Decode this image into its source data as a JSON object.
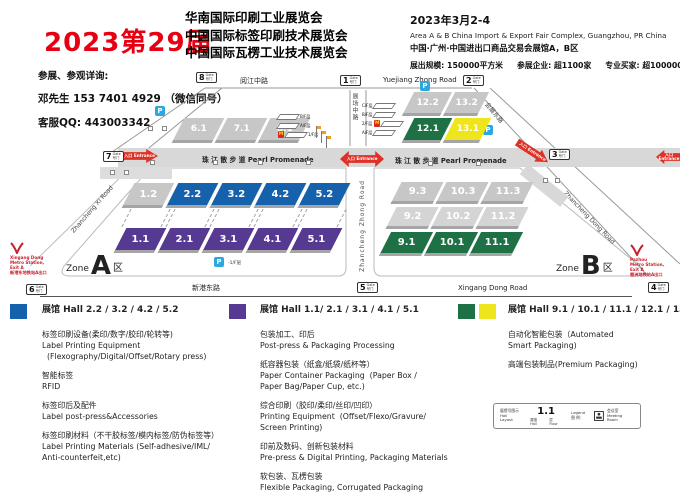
{
  "colors": {
    "red": "#e60012",
    "hall_blue": "#1661ab",
    "hall_purple": "#563a92",
    "hall_green": "#1e7145",
    "hall_yellow": "#efe51d",
    "hall_gray": "#c7c7c7",
    "arrow_red": "#df3126",
    "parking_blue": "#2aa8df",
    "metro_red": "#c8202f"
  },
  "header": {
    "edition": "2023第29届",
    "title1": "华南国际印刷工业展览会",
    "title2": "中国国际标签印刷技术展览会",
    "title3": "中国国际瓦楞工业技术展览会",
    "date": "2023年3月2-4",
    "venue_en": "Area A & B China Import & Export Fair Complex, Guangzhou, PR China",
    "venue_cn": "中国·广州·中国进出口商品交易会展馆A，B区",
    "stat_scale": "展出规模: 150000平方米",
    "stat_exhibitors": "参展企业: 超1100家",
    "stat_buyers": "专业买家: 超100000人"
  },
  "contact": {
    "line1": "参展、参观详询:",
    "line2": "邓先生 153 7401 4929 （微信同号）",
    "line3": "客服QQ: 443003342"
  },
  "map": {
    "roads": {
      "top_cn": "阅江中路",
      "top_en": "Yuejiang Zhong Road",
      "bottom_cn": "新港东路",
      "bottom_en": "Xingang Dong Road",
      "mid_cn": "展场中路",
      "upper_right_cn": "会展东路",
      "zone_a_diag": "Zhancheng Xi Road",
      "zone_b_left": "Zhancheng Zhong Road",
      "zone_b_diag": "Zhancheng Dong Road"
    },
    "promenade": "珠 江 散 步 道 Pearl Promenade",
    "entrance": "入口 Entrance",
    "gate_en": "Gate",
    "gate_cn": "号门",
    "gates": {
      "g1": "1",
      "g2": "2",
      "g3": "3",
      "g4": "4",
      "g5": "5",
      "g6": "6",
      "g7": "7",
      "g8": "8"
    },
    "parking": "P",
    "parking_note": "-1/F层",
    "zone_a": {
      "word": "Zone",
      "letter": "A",
      "cn": "区"
    },
    "zone_b": {
      "word": "Zone",
      "letter": "B",
      "cn": "区"
    },
    "metro_left": {
      "l1": "Xingang Dong",
      "l2": "Metro Station,",
      "l3": "Exit A",
      "l4": "新港东地铁站A出口"
    },
    "metro_right": {
      "l1": "Pazhou",
      "l2": "Metro Station,",
      "l3": "Exit A",
      "l4": "琶洲地铁站A出口"
    },
    "stack_a": {
      "f1": "B/F层",
      "f2": "A/F层",
      "f3": "1/F层",
      "m": "M"
    },
    "stack_b": {
      "f1": "C/F层",
      "f2": "B/F层",
      "f3": "2/F层",
      "f4": "A/F层",
      "m": "M"
    },
    "halls": {
      "h61": "6.1",
      "h71": "7.1",
      "h81": "8.1",
      "h122": "12.2",
      "h132": "13.2",
      "h121": "12.1",
      "h131": "13.1",
      "h12": "1.2",
      "h22": "2.2",
      "h32": "3.2",
      "h42": "4.2",
      "h52": "5.2",
      "h11": "1.1",
      "h21": "2.1",
      "h31": "3.1",
      "h41": "4.1",
      "h51": "5.1",
      "h93": "9.3",
      "h103": "10.3",
      "h113": "11.3",
      "h92": "9.2",
      "h102": "10.2",
      "h112": "11.2",
      "h91": "9.1",
      "h101": "10.1",
      "h111": "11.1"
    }
  },
  "legend": {
    "columns": [
      {
        "title": "展馆 Hall 2.2 / 3.2 / 4.2 / 5.2",
        "items": [
          [
            "标签印刷设备(柔印/数字/胶印/轮转等)",
            "Label Printing Equipment",
            "  (Flexography/Digital/Offset/Rotary press)"
          ],
          [
            "智能标签",
            "RFID"
          ],
          [
            "标签印后及配件",
            "Label post-press&Accessories"
          ],
          [
            "标签印刷材料（不干胶标签/模内标签/防伪标签等）",
            "Label Printing Materials (Self-adhesive/IML/",
            "Anti-counterfeit,etc)"
          ]
        ]
      },
      {
        "title": "展馆 Hall 1.1/ 2.1 / 3.1 / 4.1 / 5.1",
        "items": [
          [
            "包装加工、印后",
            "Post-press & Packaging Processing"
          ],
          [
            "纸容器包装（纸盒/纸袋/纸杯等）",
            "Paper Container Packaging  (Paper Box /",
            "Paper Bag/Paper Cup, etc.)"
          ],
          [
            "综合印刷（胶印/柔印/丝印/凹印）",
            "Printing Equipment  (Offset/Flexo/Gravure/",
            "Screen Printing)"
          ],
          [
            "印前及数码、创新包装材料",
            "Pre-press & Digital Printing, Packaging Materials"
          ],
          [
            "软包装、瓦楞包装",
            "Flexible Packaging, Corrugated Packaging"
          ]
        ]
      },
      {
        "title": "展馆 Hall 9.1 / 10.1 / 11.1 / 12.1 / 13.1",
        "items": [
          [
            "自动化智能包装（Automated",
            "Smart Packaging)"
          ],
          [
            "高端包装制品(Premium Packaging)"
          ]
        ]
      }
    ],
    "hall_key": {
      "caption_cn": "展馆号图示",
      "caption_en": "Hall Layout",
      "sample": "1.1",
      "hall_label": "展馆 Hall",
      "floor_label": "层 Floor",
      "legend_en": "Legend",
      "legend_cn": "图 例：",
      "meeting_cn": "会议室",
      "meeting_en": "Meeting Room"
    }
  }
}
